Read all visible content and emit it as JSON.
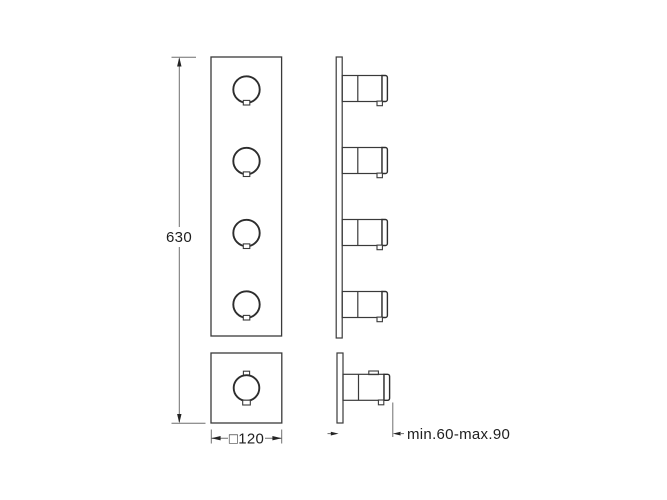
{
  "drawing": {
    "type": "technical-drawing",
    "subject": "concealed thermostatic shower valve trim - front and side elevations",
    "views": {
      "front_long_plate_knobs": 4,
      "front_square_plate_knobs": 1
    }
  },
  "labels": {
    "height_dimension": "630",
    "width_dimension": "□120",
    "depth_dimension": "min.60-max.90"
  },
  "colors": {
    "background": "#ffffff",
    "outline": "#3a3a3a",
    "dimension_line": "#6f6f6f",
    "text": "#1e1e1e"
  }
}
